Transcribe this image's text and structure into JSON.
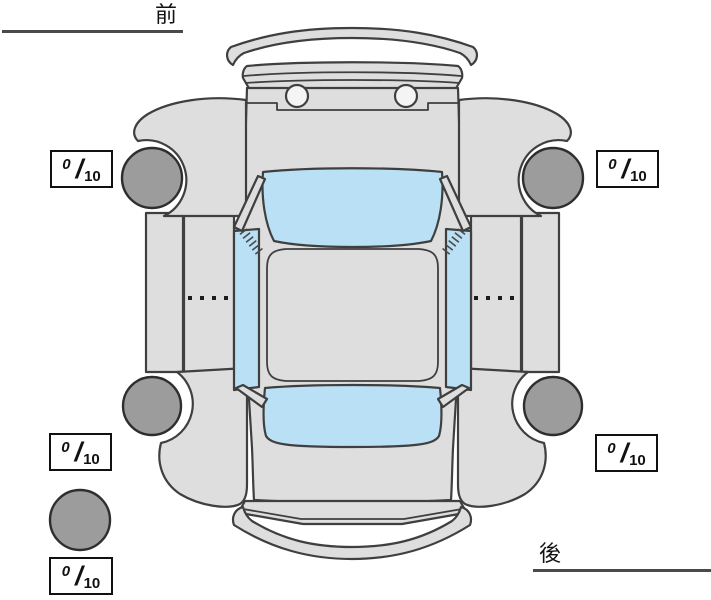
{
  "diagram": {
    "orientation_labels": {
      "front": "前",
      "rear": "後"
    },
    "tread_scores": [
      {
        "id": "front-left",
        "value": "0",
        "slash": "/",
        "max": "10"
      },
      {
        "id": "front-right",
        "value": "0",
        "slash": "/",
        "max": "10"
      },
      {
        "id": "rear-left",
        "value": "0",
        "slash": "/",
        "max": "10"
      },
      {
        "id": "rear-right",
        "value": "0",
        "slash": "/",
        "max": "10"
      },
      {
        "id": "spare",
        "value": "0",
        "slash": "/",
        "max": "10"
      }
    ],
    "colors": {
      "background": "#ffffff",
      "body": "#dedede",
      "glass": "#b9e0f5",
      "tire": "#9c9c9c",
      "outline": "#3f3f3f",
      "box_border": "#111111",
      "text": "#111111"
    }
  }
}
